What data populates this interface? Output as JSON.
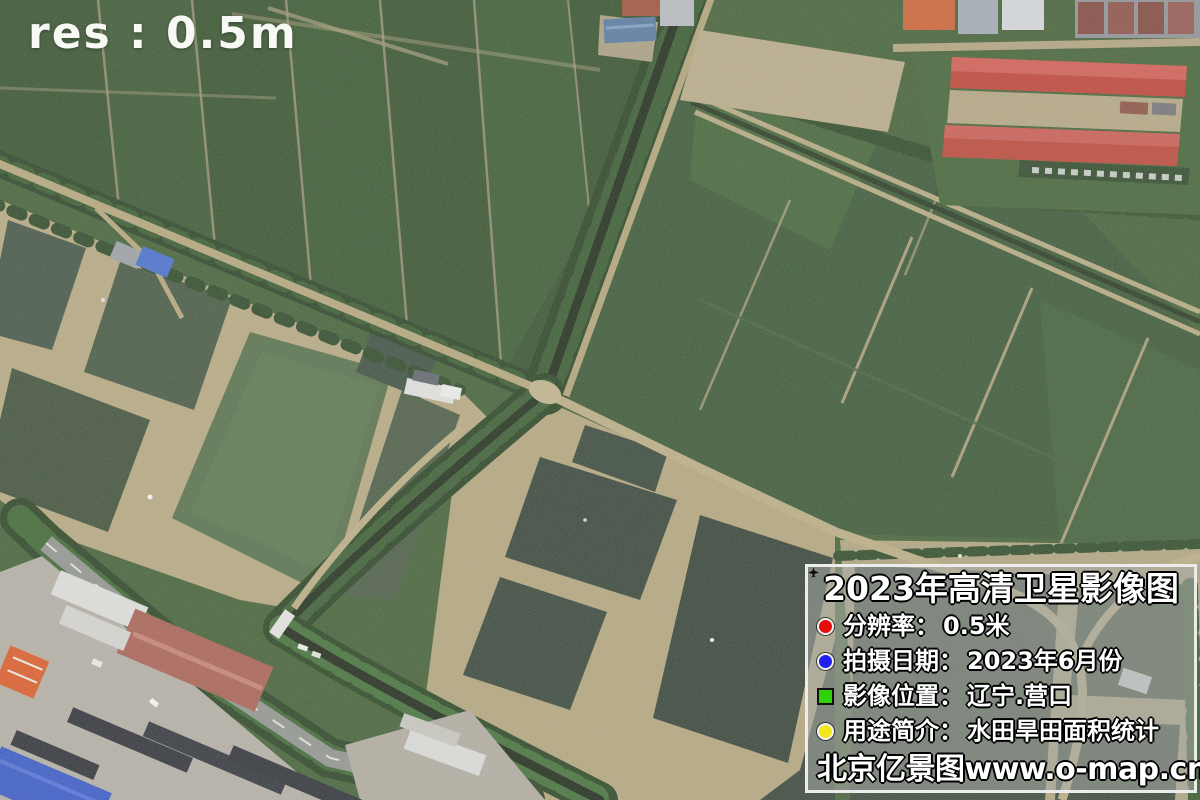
{
  "overlay": {
    "resolution_label": "res : 0.5m"
  },
  "info_panel": {
    "title": "2023年高清卫星影像图",
    "rows": [
      {
        "icon": "red-dot-icon",
        "color": "#e60c0c",
        "label": "分辨率：",
        "value": "0.5米"
      },
      {
        "icon": "blue-dot-icon",
        "color": "#2121ee",
        "label": "拍摄日期：",
        "value": "2023年6月份"
      },
      {
        "icon": "green-plane-icon",
        "color": "#2fd107",
        "label": "影像位置：",
        "value": "辽宁.营口"
      },
      {
        "icon": "yellow-dot-icon",
        "color": "#f2e71f",
        "label": "用途简介：",
        "value": "水田旱田面积统计"
      }
    ],
    "watermark": "北京亿景图www.o-map.cn"
  },
  "scene": {
    "palette": {
      "field_green_dark": "#2b4a21",
      "field_green": "#335426",
      "pond_dark": "#2c3b2e",
      "pond_algae": "#4f6b42",
      "dike_tan": "#b7a87c",
      "tree_green": "#2f5426",
      "road_grey": "#90938e",
      "roof_red": "#c03a2c",
      "roof_blue": "#2d52c9",
      "roof_orange": "#e0541c"
    }
  }
}
